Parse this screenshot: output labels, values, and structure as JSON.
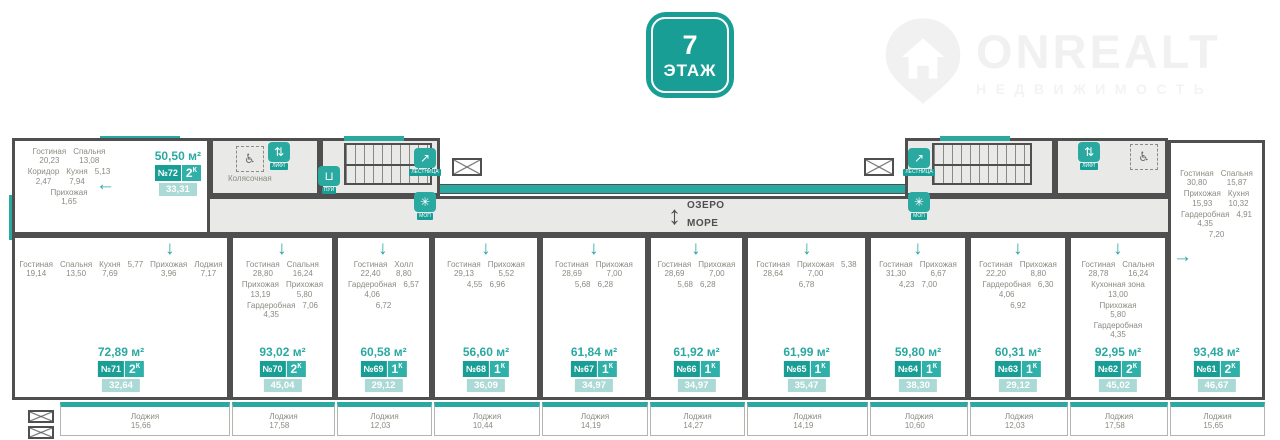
{
  "floor_badge": {
    "number": "7",
    "label": "ЭТАЖ"
  },
  "logo": {
    "brand": "ONREALT",
    "subtitle": "НЕДВИЖИМОСТЬ"
  },
  "compass": {
    "up_label": "ОЗЕРО",
    "down_label": "МОРЕ"
  },
  "common_areas": {
    "stroller_room": "Колясочная",
    "icons": {
      "elevator": "ЛИФТ",
      "stairs": "ЛЕСТНИЦА",
      "cleaning": "ПУИ",
      "service": "МОП"
    }
  },
  "colors": {
    "accent": "#2aa9a1",
    "accent_dark": "#199e96",
    "wall": "#4f4f4f"
  },
  "apartments": [
    {
      "number": "№72",
      "type": "2К",
      "total_area": "50,50 м²",
      "living_area": "33,31",
      "rooms": [
        {
          "name": "Гостиная",
          "area": "20,23"
        },
        {
          "name": "Спальня",
          "area": "13,08"
        },
        {
          "name": "Коридор",
          "area": "2,47"
        },
        {
          "name": "Кухня",
          "area": "7,94"
        },
        {
          "name": "",
          "area": "5,13"
        },
        {
          "name": "Прихожая",
          "area": "1,65"
        }
      ],
      "loggia": null
    },
    {
      "number": "№71",
      "type": "2К",
      "total_area": "72,89 м²",
      "living_area": "32,64",
      "rooms": [
        {
          "name": "Гостиная",
          "area": "19,14"
        },
        {
          "name": "Спальня",
          "area": "13,50"
        },
        {
          "name": "Кухня",
          "area": "7,69"
        },
        {
          "name": "",
          "area": "5,77"
        },
        {
          "name": "Прихожая",
          "area": "3,96"
        },
        {
          "name": "Лоджия",
          "area": "7,17"
        }
      ],
      "loggia": {
        "name": "Лоджия",
        "area": "15,66"
      }
    },
    {
      "number": "№70",
      "type": "2К",
      "total_area": "93,02 м²",
      "living_area": "45,04",
      "rooms": [
        {
          "name": "Гостиная",
          "area": "28,80"
        },
        {
          "name": "Спальня",
          "area": "16,24"
        },
        {
          "name": "Прихожая",
          "area": "13,19"
        },
        {
          "name": "Прихожая",
          "area": "5,80"
        },
        {
          "name": "Гардеробная",
          "area": "4,35"
        },
        {
          "name": "",
          "area": "7,06"
        }
      ],
      "loggia": {
        "name": "Лоджия",
        "area": "17,58"
      }
    },
    {
      "number": "№69",
      "type": "1К",
      "total_area": "60,58 м²",
      "living_area": "29,12",
      "rooms": [
        {
          "name": "Гостиная",
          "area": "22,40"
        },
        {
          "name": "Холл",
          "area": "8,80"
        },
        {
          "name": "Гардеробная",
          "area": "4,06"
        },
        {
          "name": "",
          "area": "6,57"
        },
        {
          "name": "",
          "area": "6,72"
        }
      ],
      "loggia": {
        "name": "Лоджия",
        "area": "12,03"
      }
    },
    {
      "number": "№68",
      "type": "1К",
      "total_area": "56,60 м²",
      "living_area": "36,09",
      "rooms": [
        {
          "name": "Гостиная",
          "area": "29,13"
        },
        {
          "name": "Прихожая",
          "area": "5,52"
        },
        {
          "name": "",
          "area": "4,55"
        },
        {
          "name": "",
          "area": "6,96"
        }
      ],
      "loggia": {
        "name": "Лоджия",
        "area": "10,44"
      }
    },
    {
      "number": "№67",
      "type": "1К",
      "total_area": "61,84 м²",
      "living_area": "34,97",
      "rooms": [
        {
          "name": "Гостиная",
          "area": "28,69"
        },
        {
          "name": "Прихожая",
          "area": "7,00"
        },
        {
          "name": "",
          "area": "5,68"
        },
        {
          "name": "",
          "area": "6,28"
        }
      ],
      "loggia": {
        "name": "Лоджия",
        "area": "14,19"
      }
    },
    {
      "number": "№66",
      "type": "1К",
      "total_area": "61,92 м²",
      "living_area": "34,97",
      "rooms": [
        {
          "name": "Гостиная",
          "area": "28,69"
        },
        {
          "name": "Прихожая",
          "area": "7,00"
        },
        {
          "name": "",
          "area": "5,68"
        },
        {
          "name": "",
          "area": "6,28"
        }
      ],
      "loggia": {
        "name": "Лоджия",
        "area": "14,27"
      }
    },
    {
      "number": "№65",
      "type": "1К",
      "total_area": "61,99 м²",
      "living_area": "35,47",
      "rooms": [
        {
          "name": "Гостиная",
          "area": "28,64"
        },
        {
          "name": "Прихожая",
          "area": "7,00"
        },
        {
          "name": "",
          "area": "5,38"
        },
        {
          "name": "",
          "area": "6,78"
        }
      ],
      "loggia": {
        "name": "Лоджия",
        "area": "14,19"
      }
    },
    {
      "number": "№64",
      "type": "1К",
      "total_area": "59,80 м²",
      "living_area": "38,30",
      "rooms": [
        {
          "name": "Гостиная",
          "area": "31,30"
        },
        {
          "name": "Прихожая",
          "area": "6,67"
        },
        {
          "name": "",
          "area": "4,23"
        },
        {
          "name": "",
          "area": "7,00"
        }
      ],
      "loggia": {
        "name": "Лоджия",
        "area": "10,60"
      }
    },
    {
      "number": "№63",
      "type": "1К",
      "total_area": "60,31 м²",
      "living_area": "29,12",
      "rooms": [
        {
          "name": "Гостиная",
          "area": "22,20"
        },
        {
          "name": "Прихожая",
          "area": "8,80"
        },
        {
          "name": "Гардеробная",
          "area": "4,06"
        },
        {
          "name": "",
          "area": "6,30"
        },
        {
          "name": "",
          "area": "6,92"
        }
      ],
      "loggia": {
        "name": "Лоджия",
        "area": "12,03"
      }
    },
    {
      "number": "№62",
      "type": "2К",
      "total_area": "92,95 м²",
      "living_area": "45,02",
      "rooms": [
        {
          "name": "Гостиная",
          "area": "28,78"
        },
        {
          "name": "Спальня",
          "area": "16,24"
        },
        {
          "name": "Кухонная зона",
          "area": "13,00"
        },
        {
          "name": "Прихожая",
          "area": "5,80"
        },
        {
          "name": "Гардеробная",
          "area": "4,35"
        }
      ],
      "loggia": {
        "name": "Лоджия",
        "area": "17,58"
      }
    },
    {
      "number": "№61",
      "type": "2К",
      "total_area": "93,48 м²",
      "living_area": "46,67",
      "rooms": [
        {
          "name": "Гостиная",
          "area": "30,80"
        },
        {
          "name": "Спальня",
          "area": "15,87"
        },
        {
          "name": "Прихожая",
          "area": "15,93"
        },
        {
          "name": "Кухня",
          "area": "10,32"
        },
        {
          "name": "Гардеробная",
          "area": "4,35"
        },
        {
          "name": "",
          "area": "4,91"
        },
        {
          "name": "",
          "area": "7,20"
        }
      ],
      "loggia": {
        "name": "Лоджия",
        "area": "15,65"
      }
    }
  ]
}
